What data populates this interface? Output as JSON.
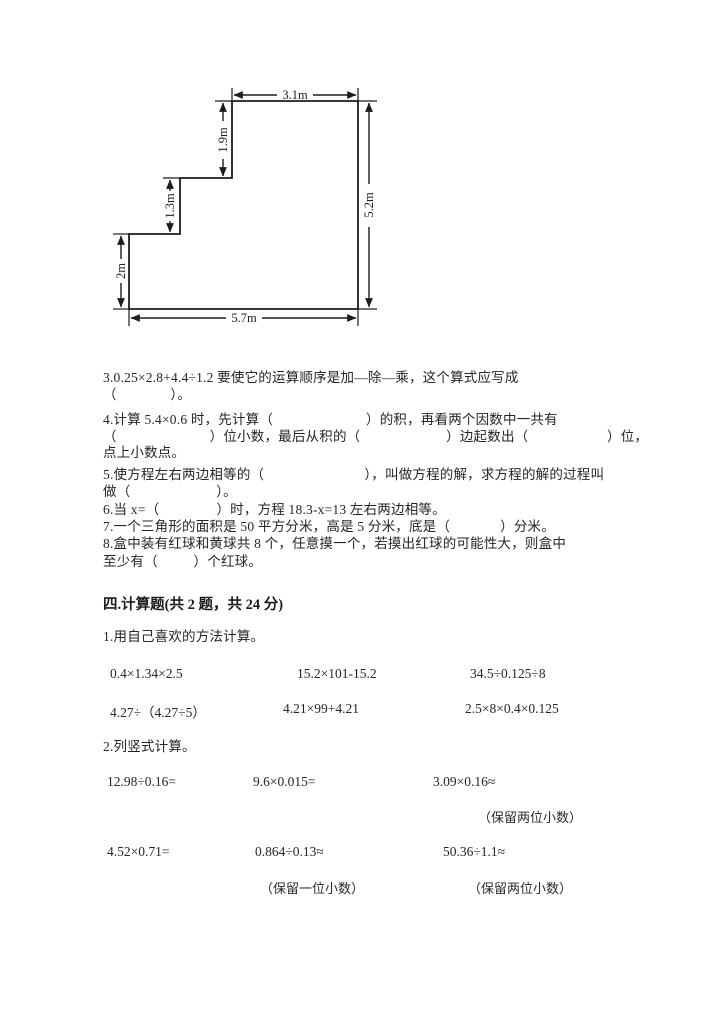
{
  "figure": {
    "dims": {
      "top": "3.1m",
      "right": "5.2m",
      "bottom": "5.7m",
      "left": "2m",
      "mid_step": "1.3m",
      "upper_step": "1.9m"
    }
  },
  "questions": {
    "q3_l1": "3.0.25×2.8+4.4÷1.2 要使它的运算顺序是加—除—乘，这个算式应写成",
    "q3_l2": "（               ）。",
    "q4_l1": "4.计算 5.4×0.6 时，先计算（                          ）的积，再看两个因数中一共有",
    "q4_l2": "（                          ）位小数，最后从积的（                        ）边起数出（                      ）位，",
    "q4_l3": "点上小数点。",
    "q5_l1": "5.使方程左右两边相等的（                            ），叫做方程的解，求方程的解的过程叫",
    "q5_l2": "做（                        ）。",
    "q6": "6.当 x=（                ）时，方程 18.3-x=13 左右两边相等。",
    "q7": "7.一个三角形的面积是 50 平方分米，高是 5 分米，底是（              ）分米。",
    "q8_l1": "8.盒中装有红球和黄球共 8 个，任意摸一个，若摸出红球的可能性大，则盒中",
    "q8_l2": "至少有（          ）个红球。"
  },
  "section": {
    "title": "四.计算题(共 2 题，共 24 分)",
    "sub1": "1.用自己喜欢的方法计算。",
    "calc_row1": [
      "0.4×1.34×2.5",
      "15.2×101-15.2",
      "34.5÷0.125÷8"
    ],
    "calc_row2": [
      "4.27÷（4.27÷5）",
      "4.21×99+4.21",
      "2.5×8×0.4×0.125"
    ],
    "sub2": "2.列竖式计算。",
    "calc_row3": [
      "12.98÷0.16=",
      "9.6×0.015=",
      "3.09×0.16≈"
    ],
    "note_r3c3": "（保留两位小数）",
    "calc_row4": [
      "4.52×0.71=",
      "0.864÷0.13≈",
      "50.36÷1.1≈"
    ],
    "note_r4c2": "（保留一位小数）",
    "note_r4c3": "（保留两位小数）"
  }
}
